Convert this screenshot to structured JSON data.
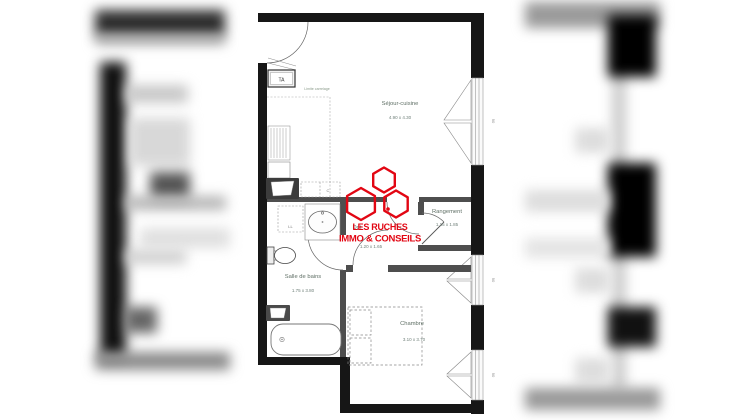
{
  "logo": {
    "line1": "LES RUCHES",
    "line2": "IMMO & CONSEILS",
    "color": "#e20613"
  },
  "rooms": {
    "sejour": {
      "name": "Séjour-cuisine",
      "dims": "4.90 x 4.30"
    },
    "rangement": {
      "name": "Rangement",
      "dims": "1.15 x 1.85"
    },
    "dgt": {
      "name": "Dgt",
      "dims": "1.20 x 1.65"
    },
    "bains": {
      "name": "Salle de bains",
      "dims": "1.75 x 3.80"
    },
    "chambre": {
      "name": "Chambre",
      "dims": "3.10 x 3.70"
    }
  },
  "annotations": {
    "ta": "TA",
    "limite_carrelage": "Limite carrelage",
    "lave_linge": "LL",
    "cuisine_c": "C",
    "window_width": "90"
  },
  "colors": {
    "outer_wall": "#161616",
    "partition": "#4e4e4e",
    "logo_red": "#e20613",
    "room_text": "#5f6f65"
  }
}
